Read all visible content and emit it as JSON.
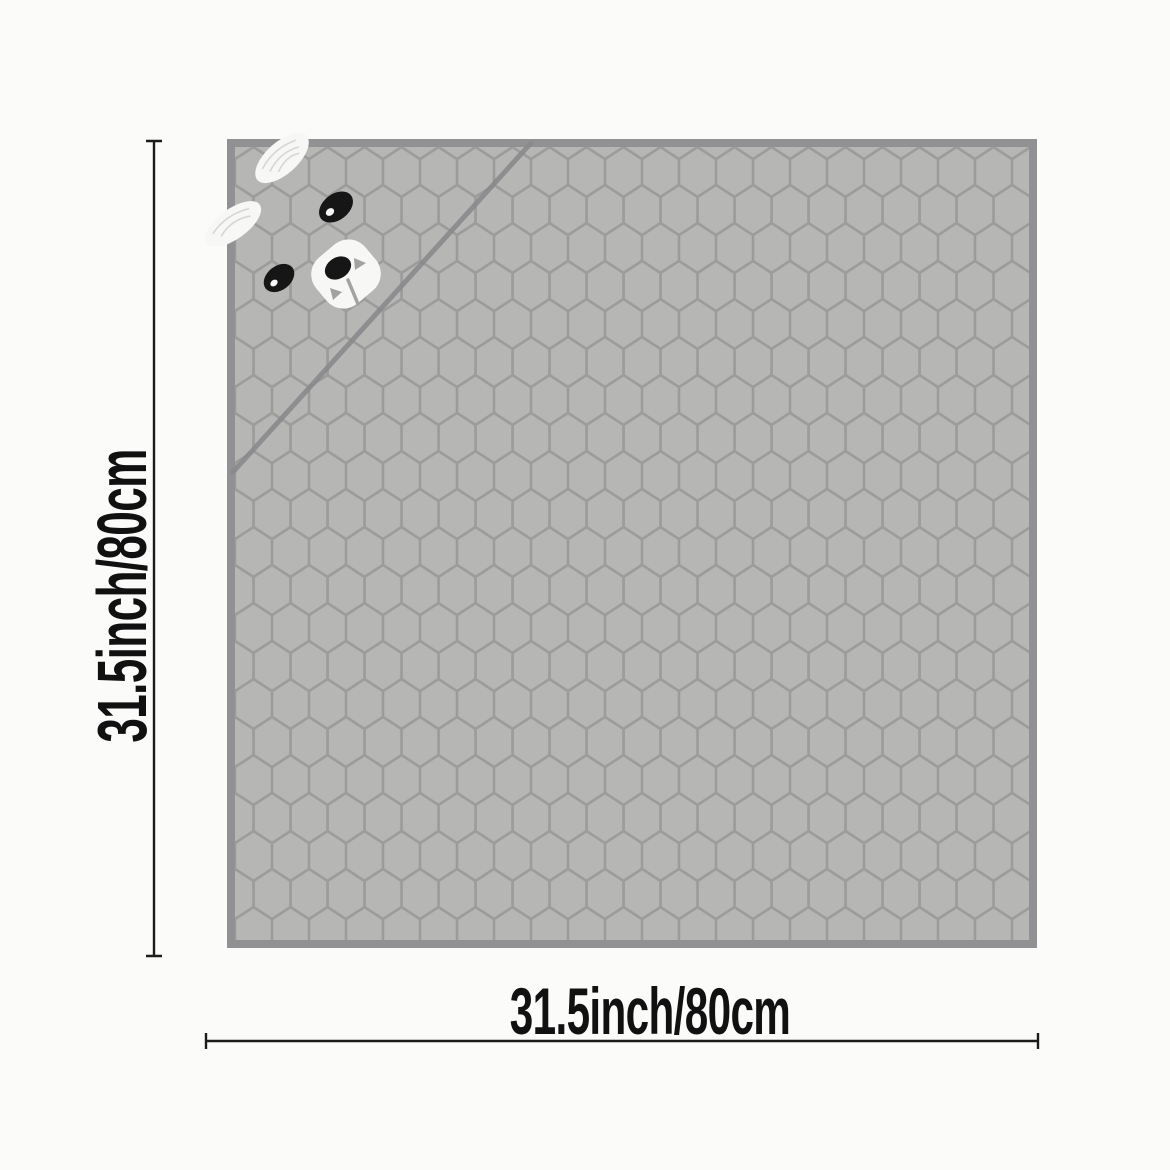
{
  "dimensions": {
    "height": {
      "label": "31.5inch/80cm",
      "inches": "31.5",
      "cm": "80"
    },
    "width": {
      "label": "31.5inch/80cm",
      "inches": "31.5",
      "cm": "80"
    }
  },
  "graphics": {
    "blanket_pattern": "honeycomb-quilted",
    "corner_motif": "bunny-face-hood"
  },
  "colors": {
    "background": "#fbfbf9",
    "fabric_cell": "#b6b6b4",
    "fabric_groove": "#9c9c9a",
    "fabric_edge": "#919193",
    "fold_line": "#8a8a8c",
    "bunny_white": "#f7f7f5",
    "bunny_black": "#161616",
    "bunny_ear_streak": "#d2d2d0",
    "bunny_gray_detail": "#a2a2a0",
    "dimension_line": "#1b1b1b",
    "label_text": "#111111"
  }
}
